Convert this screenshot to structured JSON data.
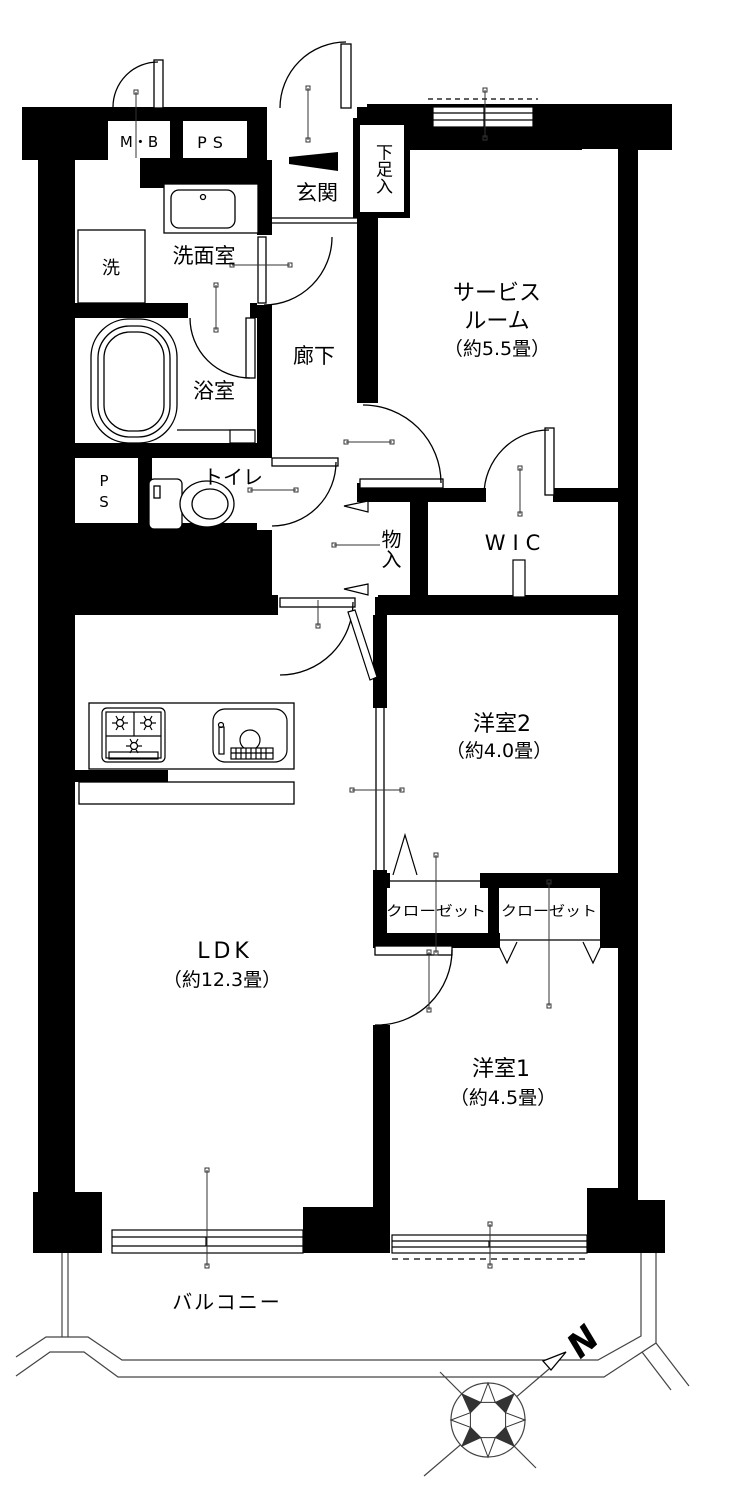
{
  "floorplan": {
    "type": "apartment-floor-plan",
    "compass": {
      "north_label": "N"
    },
    "labels": {
      "meter_box": "M・B",
      "pipe_space_top": "PS",
      "entrance": "玄関",
      "shoe_cabinet": "下足入",
      "washer": "洗",
      "washroom": "洗面室",
      "bathroom": "浴室",
      "hallway": "廊下",
      "service_room_line1": "サービス",
      "service_room_line2": "ルーム",
      "service_room_size": "（約5.5畳）",
      "pipe_space_left": "PS",
      "toilet": "トイレ",
      "storage": "物入",
      "walk_in_closet": "WIC",
      "bedroom2": "洋室2",
      "bedroom2_size": "（約4.0畳）",
      "closet_left": "クローゼット",
      "closet_right": "クローゼット",
      "ldk": "LDK",
      "ldk_size": "（約12.3畳）",
      "bedroom1": "洋室1",
      "bedroom1_size": "（約4.5畳）",
      "balcony": "バルコニー"
    },
    "colors": {
      "wall": "#000000",
      "floor": "#ffffff",
      "line": "#000000"
    }
  }
}
